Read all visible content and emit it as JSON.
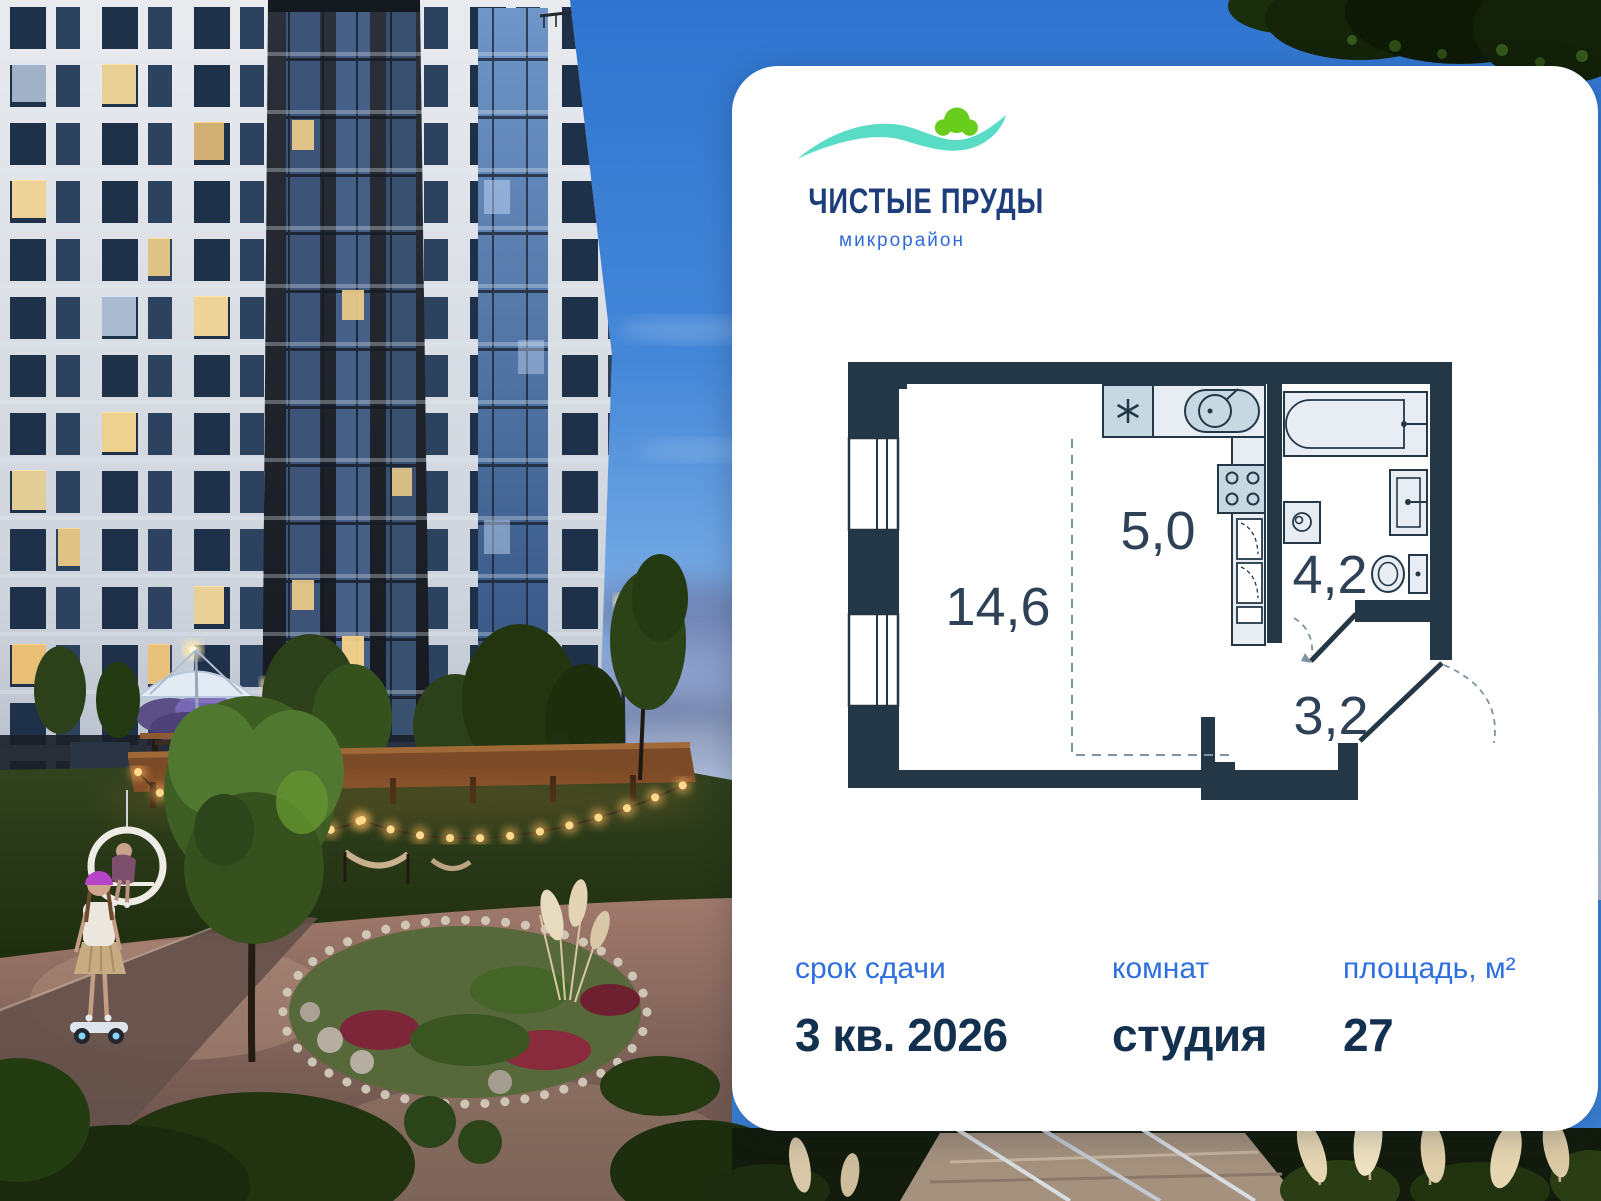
{
  "logo": {
    "title": "ЧИСТЫЕ ПРУДЫ",
    "subtitle": "микрорайон"
  },
  "plan": {
    "living_area": "14,6",
    "kitchen_area": "5,0",
    "bathroom_area": "4,2",
    "hallway_area": "3,2"
  },
  "details": {
    "completion": {
      "label": "срок сдачи",
      "value": "3 кв. 2026"
    },
    "rooms": {
      "label": "комнат",
      "value": "студия"
    },
    "area": {
      "label": "площадь, м²",
      "value": "27"
    }
  },
  "scene": {
    "entrance_sign": "Подъезд 3"
  },
  "colors": {
    "accent_blue": "#2E6FE0",
    "navy": "#14304F",
    "plan_wall": "#243747",
    "logo_navy": "#1D3E7A",
    "logo_teal": "#59DCC5",
    "logo_green": "#68CD1C",
    "sky_blue": "#3B82D9"
  }
}
